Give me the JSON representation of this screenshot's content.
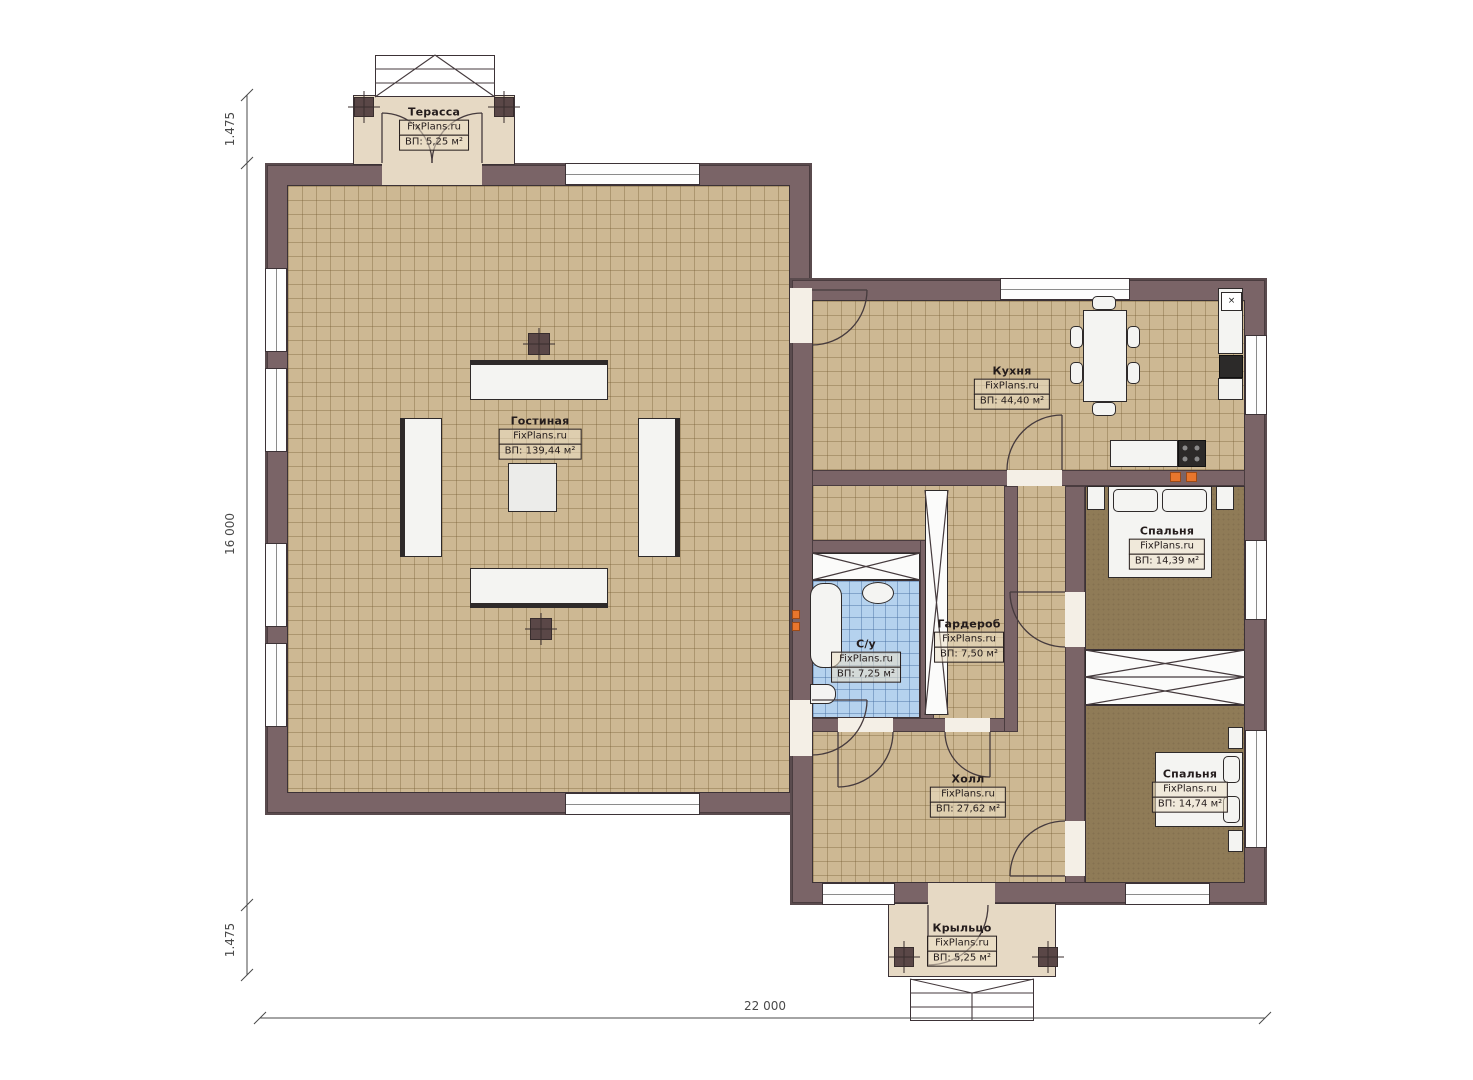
{
  "plan": {
    "watermark": "FixPlans.ru",
    "rooms": {
      "terrace": {
        "name": "Терасса",
        "area": "ВП: 5,25 м²"
      },
      "living": {
        "name": "Гостиная",
        "area": "ВП: 139,44 м²"
      },
      "kitchen": {
        "name": "Кухня",
        "area": "ВП: 44,40 м²"
      },
      "bathroom": {
        "name": "С/у",
        "area": "ВП: 7,25 м²"
      },
      "wardrobe": {
        "name": "Гардероб",
        "area": "ВП: 7,50 м²"
      },
      "bedroom1": {
        "name": "Спальня",
        "area": "ВП: 14,39 м²"
      },
      "hall": {
        "name": "Холл",
        "area": "ВП: 27,62 м²"
      },
      "bedroom2": {
        "name": "Спальня",
        "area": "ВП: 14,74 м²"
      },
      "porch": {
        "name": "Крыльцо",
        "area": "ВП: 5,25 м²"
      }
    },
    "dimensions": {
      "left_top": "1.475",
      "left_middle": "16 000",
      "left_bottom": "1.475",
      "bottom": "22 000"
    },
    "symbols": {
      "sink": "×"
    },
    "colors": {
      "wall": "#7a6467",
      "floor_tile": "#cdb893",
      "bathroom_tile": "#b5d2ee",
      "bedroom_carpet": "#8f7b57",
      "deck": "#e6d9c4",
      "marker": "#e8762d"
    }
  }
}
